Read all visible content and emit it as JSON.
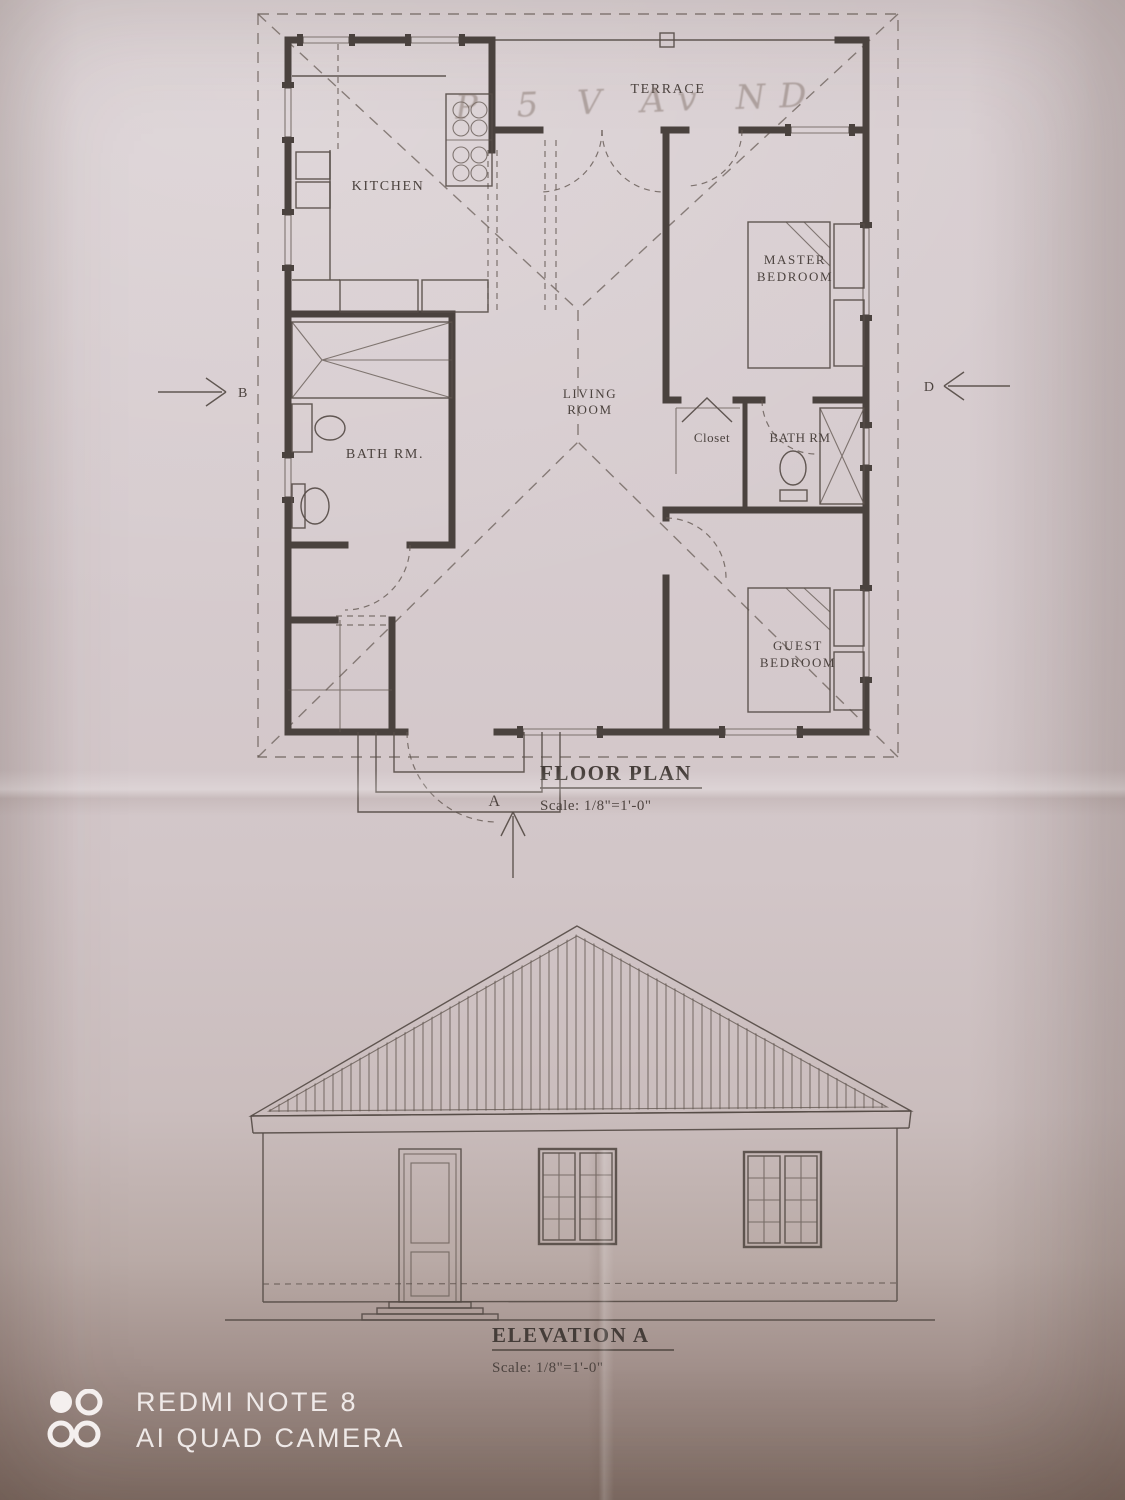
{
  "floor_plan": {
    "title": "FLOOR PLAN",
    "scale": "Scale: 1/8\"=1'-0\"",
    "handwritten_note": "P 5 V Av ND",
    "rooms": {
      "terrace": "TERRACE",
      "kitchen": "KITCHEN",
      "master_bedroom_line1": "MASTER",
      "master_bedroom_line2": "BEDROOM",
      "living_room_line1": "LIVING",
      "living_room_line2": "ROOM",
      "closet": "Closet",
      "bath_right": "BATH RM",
      "bath_left": "BATH RM.",
      "guest_bedroom_line1": "GUEST",
      "guest_bedroom_line2": "BEDROOM"
    },
    "markers": {
      "left": "B",
      "right": "D",
      "bottom": "A"
    }
  },
  "elevation": {
    "title": "ELEVATION A",
    "scale": "Scale: 1/8\"=1'-0\""
  },
  "watermark": {
    "device": "REDMI NOTE 8",
    "camera": "AI QUAD CAMERA"
  },
  "colors": {
    "ink": "#4a423e",
    "paper": "#d6cbce",
    "shadow": "#7f6d65",
    "watermark_text": "#f4efee"
  }
}
